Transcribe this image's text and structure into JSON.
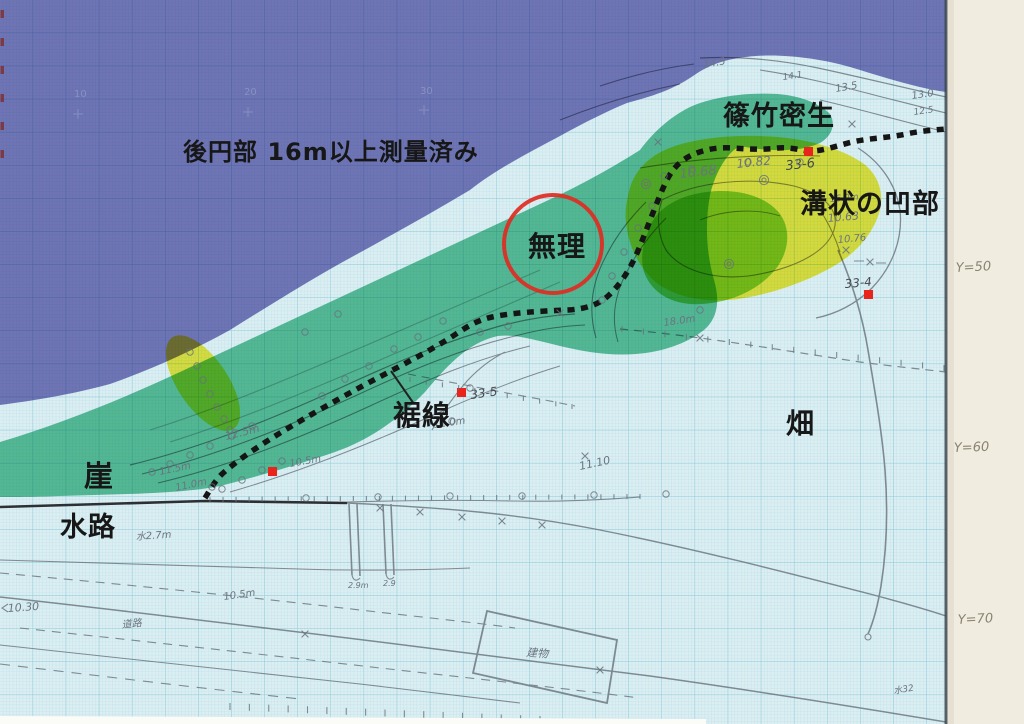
{
  "map_labels": {
    "surveyed_note": "後円部 16m以上測量済み",
    "dense_bamboo": "篠竹密生",
    "groove_depression": "溝状の凹部",
    "impossible": "無理",
    "hem_line": "裾線",
    "field": "畑",
    "cliff": "崖",
    "waterway": "水路"
  },
  "survey_points": {
    "p33_6": "33-6",
    "p33_4": "33-4",
    "p33_5": "33-5"
  },
  "margin_labels": {
    "y50": "Y=50",
    "y60": "Y=60",
    "y70": "Y=70"
  },
  "grid_numbers": {
    "g10": "10",
    "g20": "20",
    "g30": "30"
  },
  "handwritten_values": {
    "e14_5": "14.5",
    "e14_1": "14.1",
    "e13_5": "13.5",
    "e13_0": "13.0",
    "e12_5": "12.5",
    "e10_68": "10.68",
    "e10_82": "10.82",
    "e10_63": "10.63",
    "e10_76": "10.76",
    "e16_0m": "16.0m",
    "e18_0m": "18.0m",
    "e12_5m": "12.5m",
    "e11_5m": "11.5m",
    "e11_0m": "11.0m",
    "e10_5m": "10.5m",
    "e11_0m_b": "11.0m",
    "e11_10": "11.10",
    "e10_30": "10.30",
    "e10_5m_b": "10.5m",
    "mizu_w": "水2.7m",
    "douro": "道路",
    "tatemono": "建物",
    "mizu32": "水32",
    "e2_9m": "2.9m",
    "e2_9": "2.9"
  },
  "colors": {
    "paper": "#dbeef2",
    "grid_minor": "#b6dde6",
    "grid_major": "#8ccadb",
    "purple_overlay": "#7d79bc",
    "teal_overlay": "#58c197",
    "yellow_overlay": "#f6e832",
    "green_overlay": "#77d041",
    "red_marks": "#e8241c",
    "margin_paper": "#f0ecdf",
    "pencil": "#68727b"
  }
}
